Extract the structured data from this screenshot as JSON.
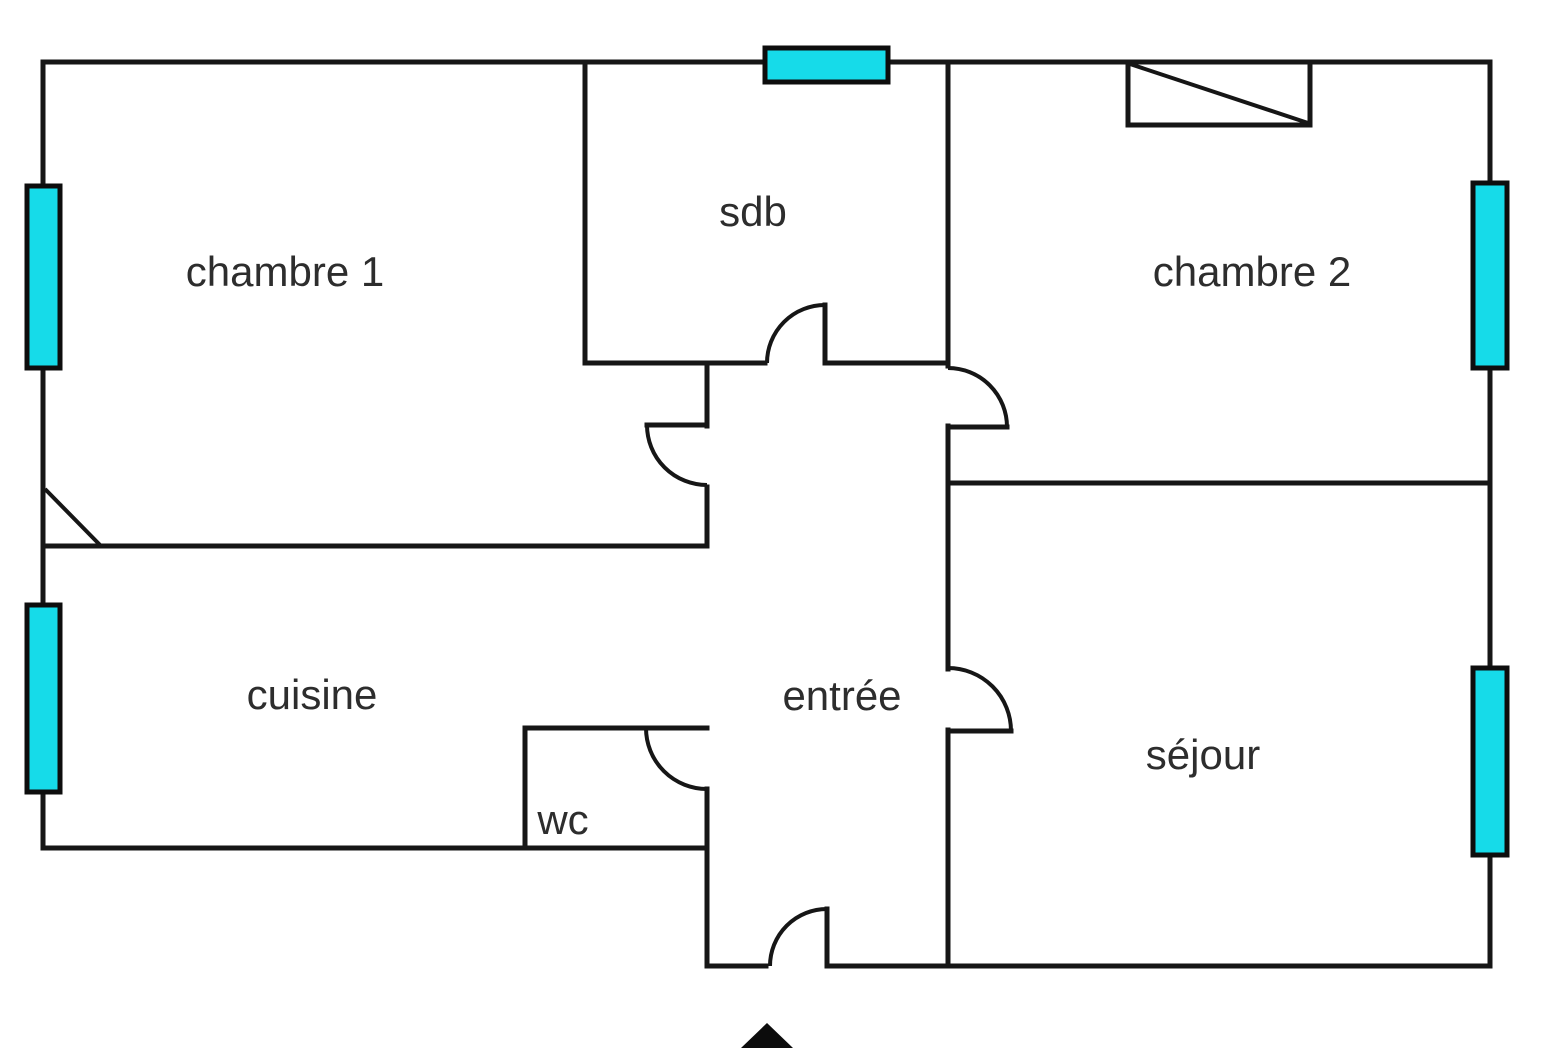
{
  "title": "Plan d'appartement (floor plan)",
  "canvas": {
    "width": 1566,
    "height": 1048,
    "background": "#ffffff"
  },
  "style": {
    "wall_color": "#161616",
    "wall_width": 5,
    "window_fill": "#16dbe9",
    "window_stroke": "#0d0d0d",
    "window_stroke_width": 5,
    "label_color": "#2d2d2d",
    "label_font_size": 42
  },
  "rooms": [
    {
      "id": "chambre-1",
      "label": "chambre 1",
      "cx": 285,
      "cy": 272
    },
    {
      "id": "sdb",
      "label": "sdb",
      "cx": 753,
      "cy": 212
    },
    {
      "id": "chambre-2",
      "label": "chambre 2",
      "cx": 1252,
      "cy": 272
    },
    {
      "id": "cuisine",
      "label": "cuisine",
      "cx": 312,
      "cy": 695
    },
    {
      "id": "entree",
      "label": "entrée",
      "cx": 842,
      "cy": 696
    },
    {
      "id": "wc",
      "label": "wc",
      "cx": 563,
      "cy": 820
    },
    {
      "id": "sejour",
      "label": "séjour",
      "cx": 1203,
      "cy": 755
    }
  ],
  "plan": {
    "walls": [
      {
        "name": "outer-top",
        "seg": [
          43,
          62,
          1490,
          62
        ]
      },
      {
        "name": "outer-left",
        "seg": [
          43,
          62,
          43,
          848
        ]
      },
      {
        "name": "outer-right",
        "seg": [
          1490,
          62,
          1490,
          966
        ]
      },
      {
        "name": "cuisine-bottom",
        "seg": [
          43,
          848,
          707,
          848
        ]
      },
      {
        "name": "sdb-left",
        "seg": [
          585,
          62,
          585,
          363
        ]
      },
      {
        "name": "sdb-bottom-left",
        "seg": [
          585,
          363,
          765,
          363
        ]
      },
      {
        "name": "sdb-bottom-right",
        "seg": [
          825,
          363,
          948,
          363
        ]
      },
      {
        "name": "sdb-chambre2-divider",
        "seg": [
          948,
          62,
          948,
          366
        ]
      },
      {
        "name": "chambre1-nook-stub",
        "seg": [
          707,
          363,
          707,
          426
        ]
      },
      {
        "name": "chambre1-nook-lower",
        "seg": [
          707,
          487,
          707,
          546
        ]
      },
      {
        "name": "chambre1-cuisine-wall",
        "seg": [
          43,
          546,
          707,
          546
        ]
      },
      {
        "name": "entree-chambre2-wall",
        "seg": [
          948,
          426,
          948,
          669
        ]
      },
      {
        "name": "entree-sejour-wall",
        "seg": [
          948,
          730,
          948,
          966
        ]
      },
      {
        "name": "chambre2-sejour-wall",
        "seg": [
          948,
          483,
          1490,
          483
        ]
      },
      {
        "name": "wc-left",
        "seg": [
          525,
          728,
          525,
          848
        ]
      },
      {
        "name": "wc-top",
        "seg": [
          525,
          728,
          707,
          728
        ]
      },
      {
        "name": "entree-left-lower",
        "seg": [
          707,
          789,
          707,
          966
        ]
      },
      {
        "name": "bottom-left-of-entry",
        "seg": [
          707,
          966,
          766,
          966
        ]
      },
      {
        "name": "bottom-right-of-entry",
        "seg": [
          828,
          966,
          1490,
          966
        ]
      }
    ],
    "door_leaves": [
      {
        "name": "sdb-door-leaf",
        "seg": [
          825,
          305,
          825,
          363
        ]
      },
      {
        "name": "chambre1-door-leaf",
        "seg": [
          647,
          425,
          707,
          425
        ]
      },
      {
        "name": "chambre2-door-leaf",
        "seg": [
          948,
          427,
          1007,
          427
        ]
      },
      {
        "name": "sejour-door-leaf",
        "seg": [
          948,
          731,
          1011,
          731
        ]
      },
      {
        "name": "entrance-door-leaf",
        "seg": [
          827,
          909,
          827,
          966
        ]
      }
    ],
    "door_arcs": [
      {
        "name": "sdb-door-arc",
        "d": "M 767 363 A 58 58 0 0 1 825 305"
      },
      {
        "name": "chambre1-door-arc",
        "d": "M 647 425 A 60 60 0 0 0 707 485"
      },
      {
        "name": "chambre2-door-arc",
        "d": "M 948 368 A 59 59 0 0 1 1007 427"
      },
      {
        "name": "sejour-door-arc",
        "d": "M 948 668 A 63 63 0 0 1 1011 731"
      },
      {
        "name": "wc-door-arc",
        "d": "M 646 728 A 61 61 0 0 0 707 789"
      },
      {
        "name": "entrance-door-arc",
        "d": "M 770 966 A 57 57 0 0 1 827 909"
      }
    ],
    "windows": [
      {
        "name": "chambre1-window",
        "rect": [
          27,
          186,
          33,
          182
        ]
      },
      {
        "name": "cuisine-window",
        "rect": [
          27,
          605,
          33,
          187
        ]
      },
      {
        "name": "sdb-window",
        "rect": [
          765,
          48,
          123,
          34
        ]
      },
      {
        "name": "chambre2-window",
        "rect": [
          1473,
          183,
          34,
          185
        ]
      },
      {
        "name": "sejour-window",
        "rect": [
          1473,
          668,
          34,
          187
        ]
      }
    ],
    "closet": {
      "rect": [
        1128,
        62,
        182,
        63
      ],
      "diagonal": [
        1130,
        64,
        1308,
        123
      ]
    },
    "corner_diagonal": [
      45,
      489,
      101,
      546
    ],
    "entrance_arrow": "767,1023 741,1048 793,1048"
  }
}
